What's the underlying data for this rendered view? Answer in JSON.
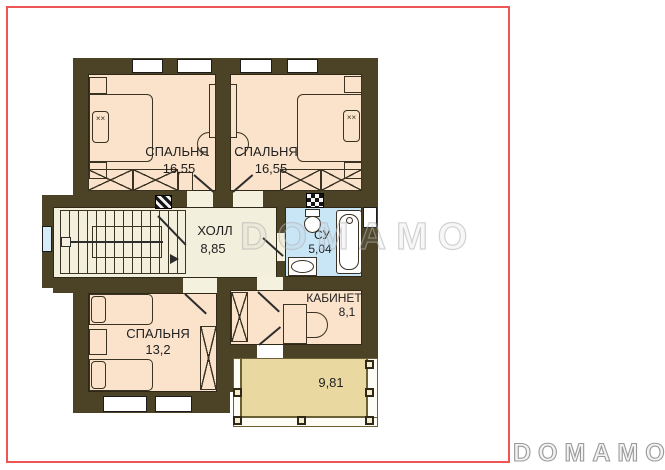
{
  "watermark": {
    "center_text": "DOMAMO",
    "logo_text": "DOMAMO"
  },
  "rooms": {
    "bedroom_top_left": {
      "label": "СПАЛЬНЯ",
      "area": "16,55"
    },
    "bedroom_top_right": {
      "label": "СПАЛЬНЯ",
      "area": "16,55"
    },
    "bedroom_bottom": {
      "label": "СПАЛЬНЯ",
      "area": "13,2"
    },
    "hall": {
      "label": "ХОЛЛ",
      "area": "8,85"
    },
    "bathroom": {
      "label": "СУ",
      "area": "5,04"
    },
    "office": {
      "label": "КАБИНЕТ",
      "area": "8,1"
    },
    "terrace": {
      "area": "9,81"
    }
  },
  "decor": {
    "pillow_mark": "××"
  },
  "colors": {
    "wall": "#4c4226",
    "bedroom_floor": "#fae2cb",
    "hall_floor": "#f2efdc",
    "bathroom_floor": "#c9e6f7",
    "terrace_floor": "#e9d9a1",
    "frame_red": "#ee5656",
    "watermark_gray": "#b3b3b3"
  }
}
